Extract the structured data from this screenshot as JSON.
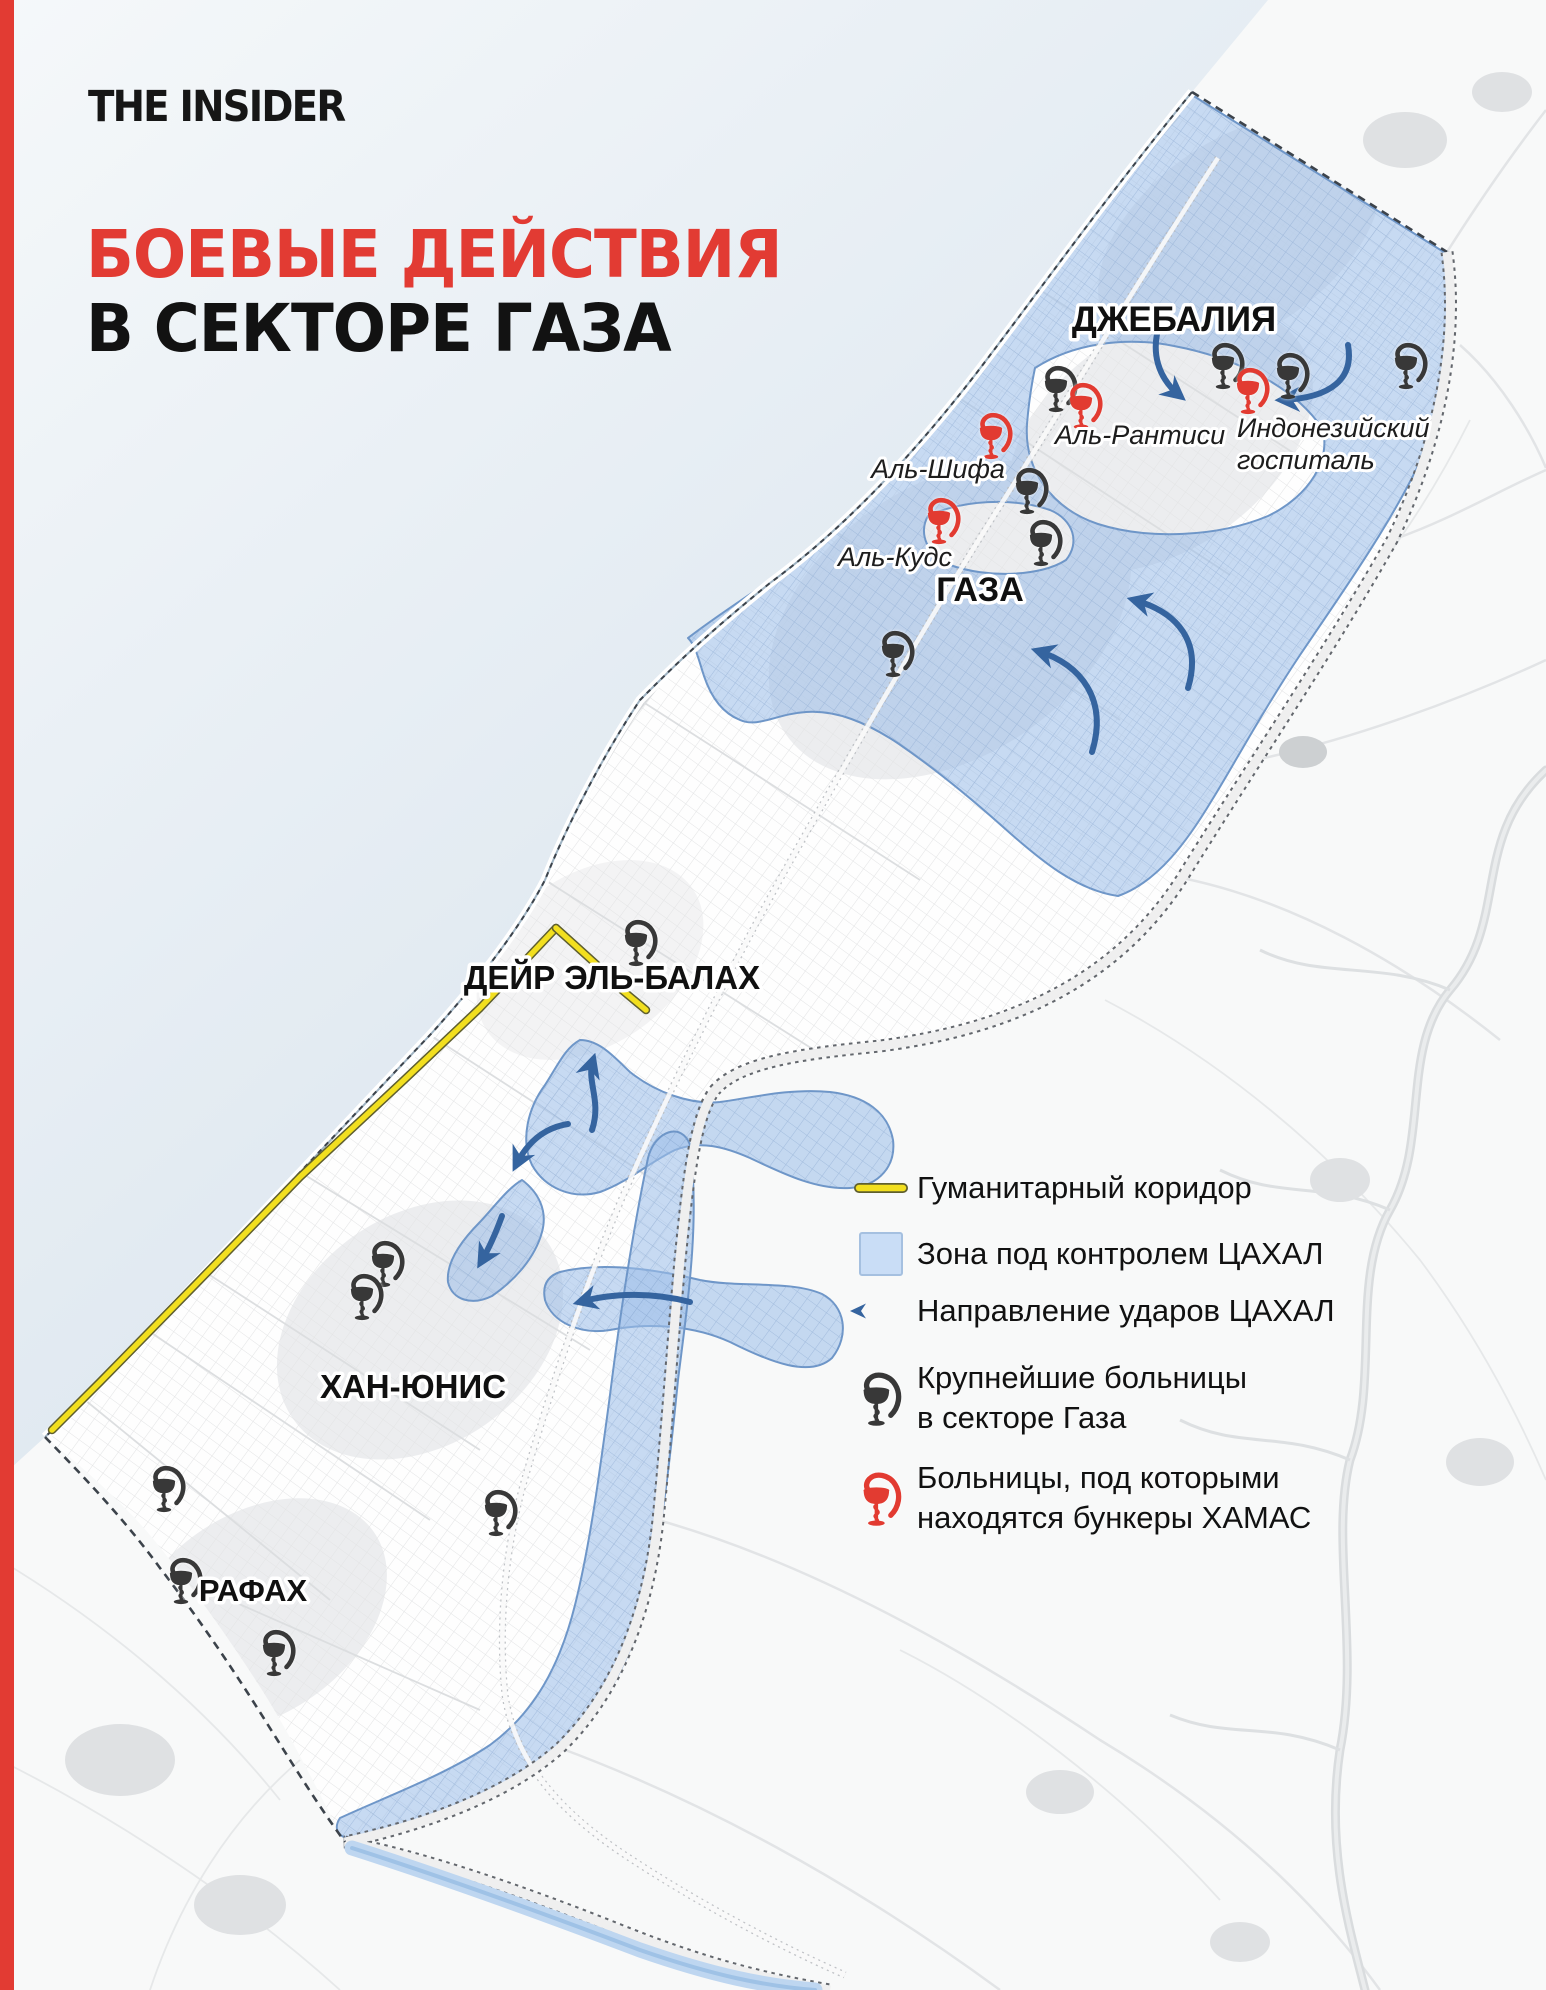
{
  "brand": {
    "logo": "THE INSIDER"
  },
  "title": {
    "line1": "БОЕВЫЕ ДЕЙСТВИЯ",
    "line2": "В СЕКТОРЕ ГАЗА"
  },
  "colors": {
    "accent_red": "#E23B33",
    "idf_zone": "#9FC0E8",
    "idf_zone_light": "#C9DDF6",
    "arrow": "#35649F",
    "corridor": "#F2DF1F",
    "hospital_black": "#383838",
    "hospital_red": "#E23B31",
    "sea_1": "#F5F8FA",
    "sea_2": "#DCE6EF"
  },
  "map": {
    "cities": [
      {
        "id": "jabalia",
        "label": "ДЖЕБАЛИЯ"
      },
      {
        "id": "gaza",
        "label": "ГАЗА"
      },
      {
        "id": "deir-el-balah",
        "label": "ДЕЙР ЭЛЬ-БАЛАХ"
      },
      {
        "id": "khan-yunis",
        "label": "ХАН-ЮНИС"
      },
      {
        "id": "rafah",
        "label": "РАФАХ"
      }
    ],
    "hospitals": [
      {
        "id": "al-shifa",
        "label": "Аль-Шифа"
      },
      {
        "id": "al-quds",
        "label": "Аль-Кудс"
      },
      {
        "id": "al-rantisi",
        "label": "Аль-Рантиси"
      },
      {
        "id": "indonesian",
        "line1": "Индонезийский",
        "line2": "госпиталь"
      }
    ]
  },
  "legend": {
    "items": [
      {
        "icon": "corridor-line",
        "label": "Гуманитарный коридор"
      },
      {
        "icon": "zone-swatch",
        "label": "Зона под контролем ЦАХАЛ"
      },
      {
        "icon": "strike-arrow",
        "label": "Направление ударов ЦАХАЛ"
      },
      {
        "icon": "hospital-black",
        "line1": "Крупнейшие больницы",
        "line2": "в секторе Газа"
      },
      {
        "icon": "hospital-red",
        "line1": "Больницы, под которыми",
        "line2": "находятся бункеры ХАМАС"
      }
    ]
  }
}
